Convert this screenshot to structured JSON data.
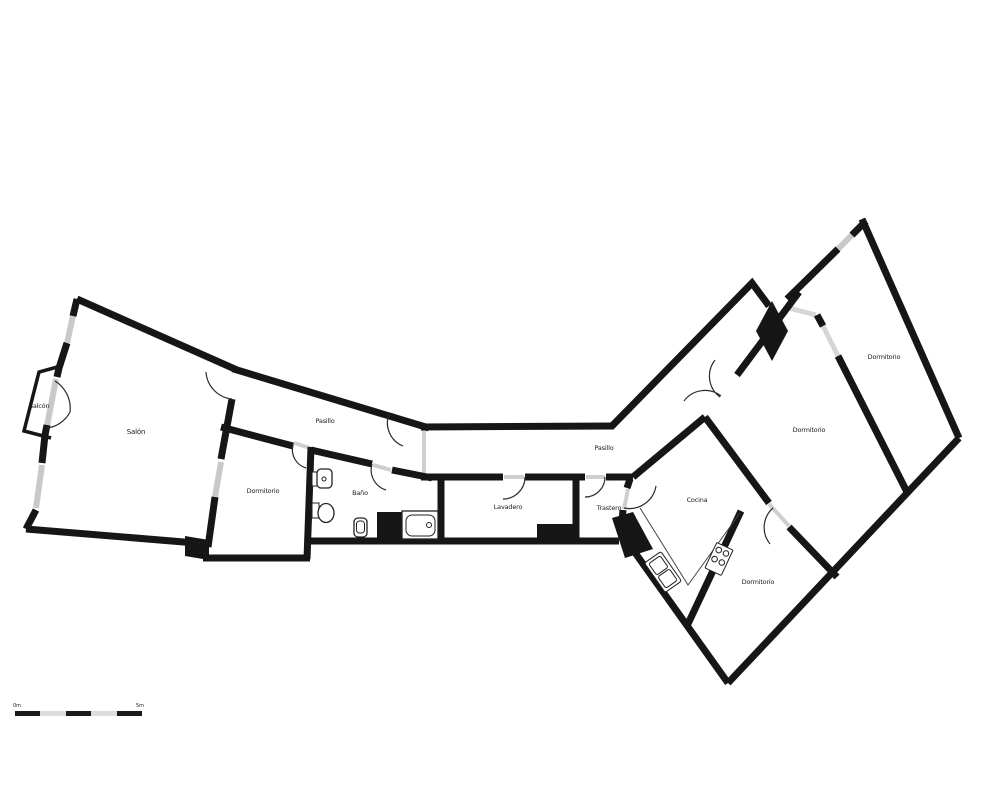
{
  "plan": {
    "wall_color": "#161616",
    "window_color": "#c9c9c9",
    "background": "#ffffff",
    "rooms": [
      {
        "id": "balcon",
        "label": "Balcón",
        "x": 39,
        "y": 406
      },
      {
        "id": "salon",
        "label": "Salón",
        "x": 136,
        "y": 432
      },
      {
        "id": "pasillo-izquierdo",
        "label": "Pasillo",
        "x": 325,
        "y": 421
      },
      {
        "id": "dormitorio-izq",
        "label": "Dormitorio",
        "x": 263,
        "y": 491
      },
      {
        "id": "bano",
        "label": "Baño",
        "x": 360,
        "y": 493
      },
      {
        "id": "lavadero",
        "label": "Lavadero",
        "x": 508,
        "y": 507
      },
      {
        "id": "pasillo-central",
        "label": "Pasillo",
        "x": 604,
        "y": 448
      },
      {
        "id": "trastero",
        "label": "Trastero",
        "x": 609,
        "y": 508
      },
      {
        "id": "cocina",
        "label": "Cocina",
        "x": 697,
        "y": 500
      },
      {
        "id": "dormitorio-centro",
        "label": "Dormitorio",
        "x": 809,
        "y": 430
      },
      {
        "id": "dormitorio-sup",
        "label": "Dormitorio",
        "x": 884,
        "y": 357
      },
      {
        "id": "dormitorio-inf",
        "label": "Dormitorio",
        "x": 758,
        "y": 582
      }
    ],
    "fixtures": [
      {
        "name": "bathtub-icon"
      },
      {
        "name": "wall-toilet-icon"
      },
      {
        "name": "toilet-icon"
      },
      {
        "name": "pedestal-sink-icon"
      },
      {
        "name": "kitchen-counter"
      },
      {
        "name": "kitchen-sink-icon"
      },
      {
        "name": "stove-icon"
      }
    ],
    "scale_bar": {
      "label_start": "0m",
      "label_end": "5m",
      "segments": 5,
      "dark_color": "#1a1a1a",
      "light_color": "#dcdcdc"
    }
  }
}
